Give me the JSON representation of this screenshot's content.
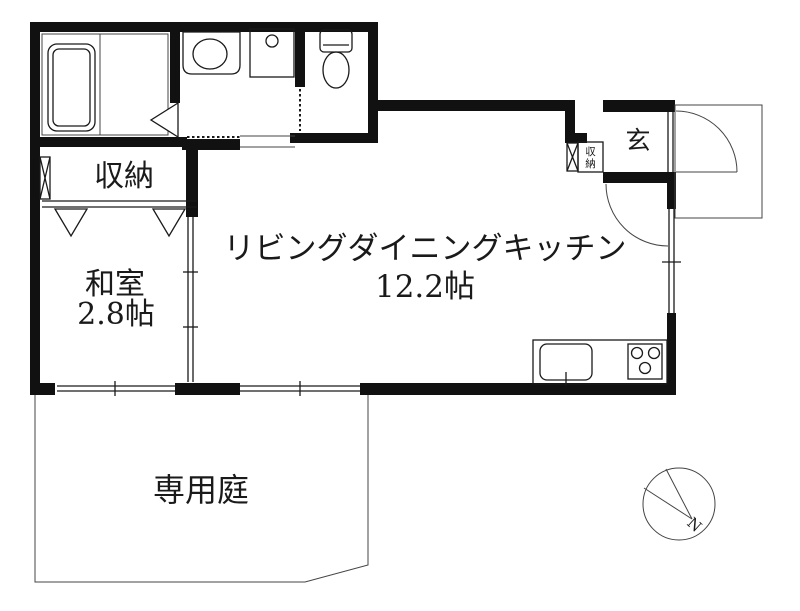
{
  "page": {
    "type": "apartment-floor-plan",
    "background_color": "#ffffff",
    "line_color": "#1a1a1a",
    "wall_color": "#111111"
  },
  "rooms": {
    "ldk": {
      "name": "リビングダイニングキッチン",
      "size": "12.2帖"
    },
    "japanese_room": {
      "name": "和室",
      "size": "2.8帖"
    },
    "storage_label": "収納",
    "entrance_label": "玄",
    "entrance_storage": {
      "char1": "収",
      "char2": "納"
    },
    "garden_label": "専用庭"
  },
  "fixtures": [
    "bathtub",
    "washbasin",
    "washing-machine-pan",
    "toilet",
    "kitchen-sink",
    "stove",
    "entrance-door",
    "room-door-arc"
  ],
  "compass": {
    "north": "N"
  }
}
